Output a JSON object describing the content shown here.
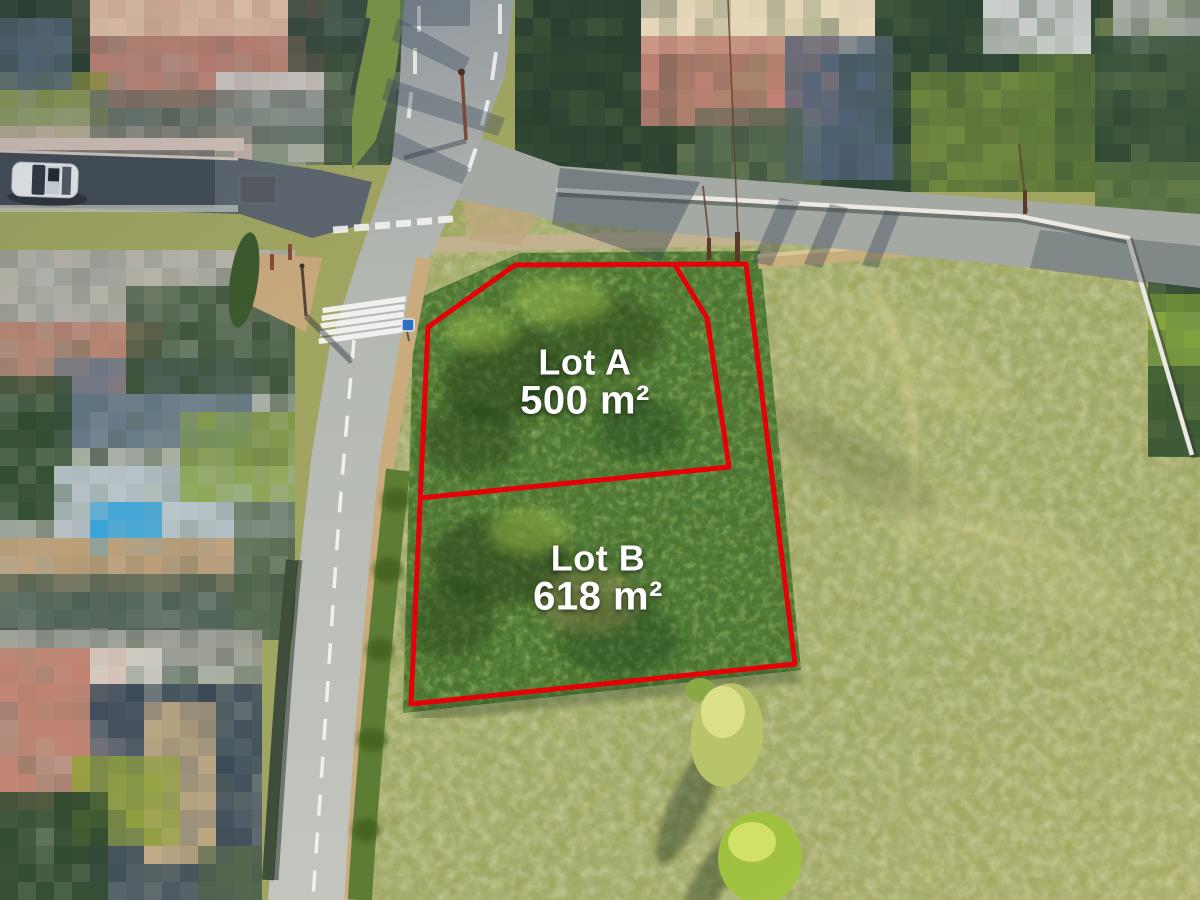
{
  "lots": [
    {
      "name": "Lot A",
      "area": "500 m²"
    },
    {
      "name": "Lot B",
      "area": "618 m²"
    }
  ],
  "colors": {
    "boundary_red": "#e60008",
    "label_text": "#ffffff"
  }
}
